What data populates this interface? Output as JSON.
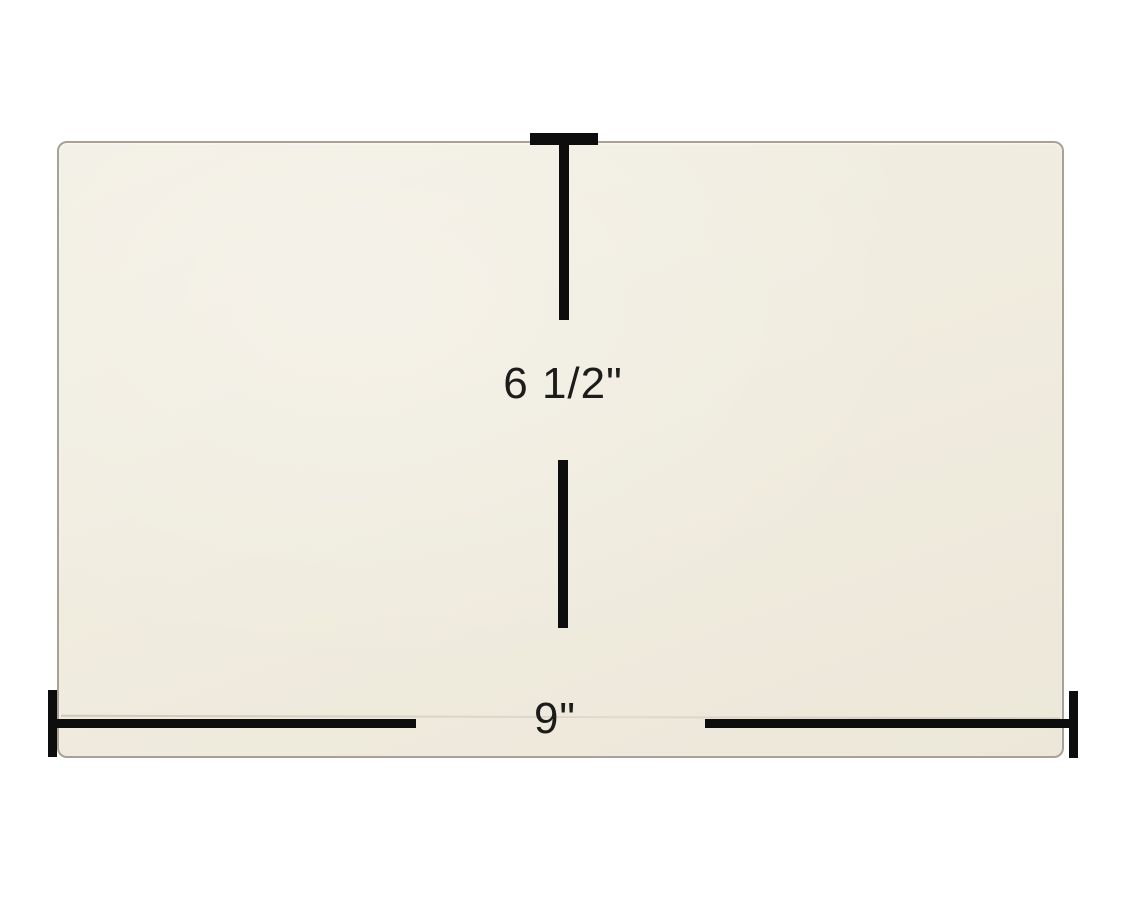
{
  "image": {
    "description": "Replacement glass panel product photo with measurement annotations",
    "background_color": "#ffffff"
  },
  "panel": {
    "name": "glass-panel",
    "fill_color": "#f0ecdf",
    "edge_color": "#a9a294"
  },
  "annotations": {
    "line_color": "#0d0d0d",
    "text_color": "#1c1c1c",
    "vertical": {
      "label": "6 1/2\""
    },
    "horizontal": {
      "label": "9\""
    }
  }
}
